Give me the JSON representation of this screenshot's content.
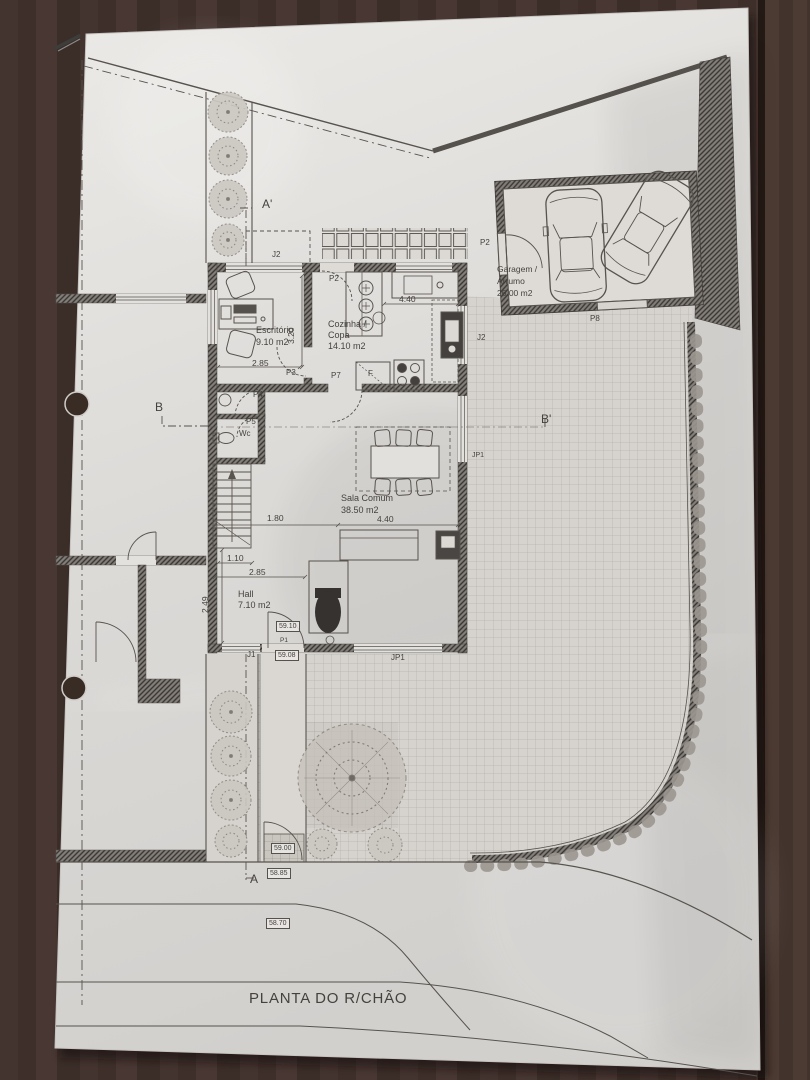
{
  "title": "PLANTA DO R/CHÃO",
  "rooms": {
    "escritorio": {
      "name": "Escritório",
      "area": "9.10 m2"
    },
    "cozinha": {
      "name": "Cozinha /",
      "name2": "Copa",
      "area": "14.10 m2"
    },
    "sala": {
      "name": "Sala Comum",
      "area": "38.50 m2"
    },
    "hall": {
      "name": "Hall",
      "area": "7.10 m2"
    },
    "garagem": {
      "name": "Garagem /",
      "name2": "Arrumo",
      "area": "26.00 m2"
    }
  },
  "dimensions": {
    "escritorio_width": "2.85",
    "escritorio_depth": "3.20",
    "cozinha_width": "4.40",
    "sala_width": "4.40",
    "sala_left": "1.80",
    "hall_window": "1.10",
    "hall_width": "2.85",
    "hall_depth": "2.49"
  },
  "openings": {
    "j1": "J1",
    "j2_top": "J2",
    "j2_side": "J2",
    "jp1_side": "JP1",
    "jp1_front": "JP1",
    "p1": "P1",
    "p2_garage": "P2",
    "p2_kitchen": "P2",
    "p3": "P3",
    "p4": "P4",
    "p5": "P5",
    "p7": "P7",
    "p8": "P8",
    "wc": "Wc",
    "fridge": "F"
  },
  "levels": {
    "hall": "59.10",
    "entry": "59.08",
    "path": "59.00",
    "sidewalk": "58.85",
    "street": "58.70"
  },
  "sections": {
    "a": "A",
    "a_prime": "A'",
    "b": "B",
    "b_prime": "B'"
  }
}
